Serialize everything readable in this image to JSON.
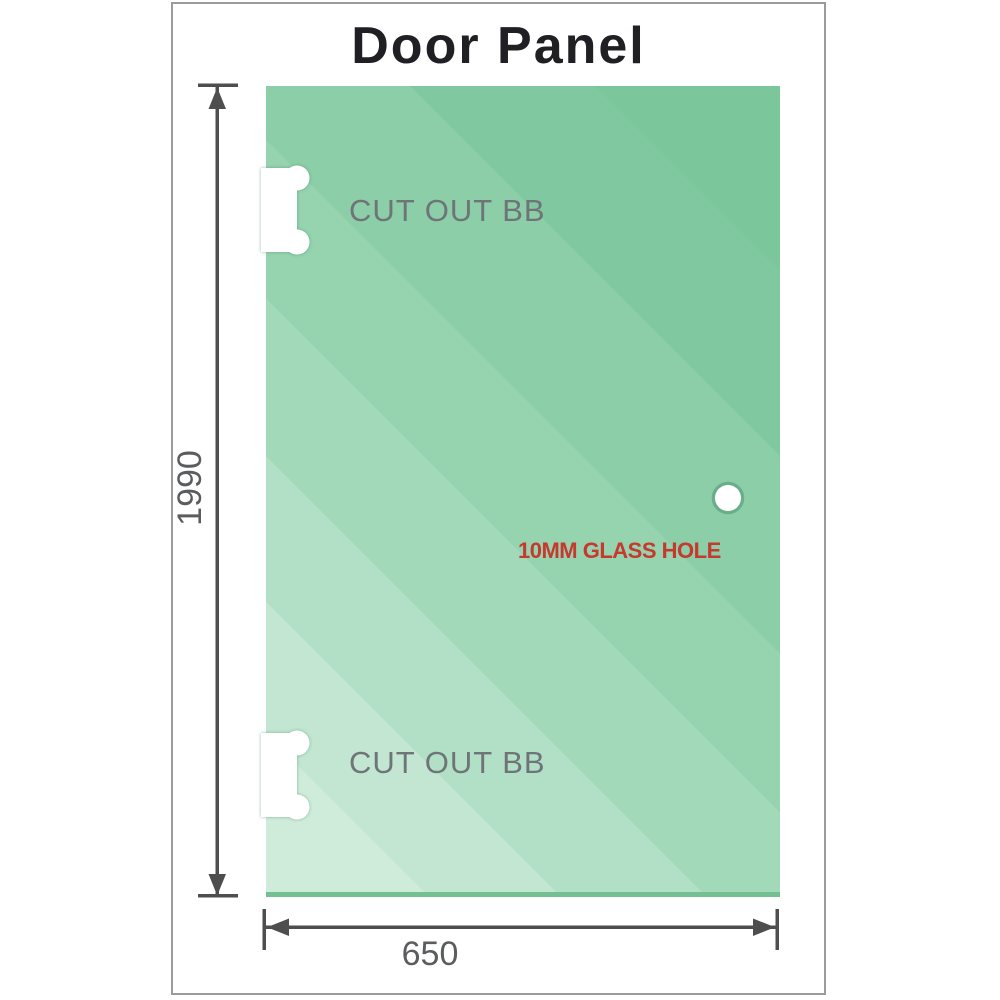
{
  "title": "Door Panel",
  "diagram": {
    "dimensions": {
      "height": "1990",
      "width": "650"
    },
    "cutouts": [
      {
        "label": "CUT OUT BB"
      },
      {
        "label": "CUT OUT BB"
      }
    ],
    "hole": {
      "label": "10MM GLASS HOLE"
    }
  },
  "colors": {
    "glass_light": "#cfecdb",
    "glass_dark": "#7cc69c",
    "glass_bottom_edge": "#73c093",
    "dimension_line": "#4e4e4e",
    "dimension_text": "#5a5c5e",
    "cutout_text": "#6f7478",
    "hole_text": "#c5392e",
    "title_text": "#1f1f24",
    "frame_border": "#9b9b9b",
    "background": "#ffffff"
  }
}
